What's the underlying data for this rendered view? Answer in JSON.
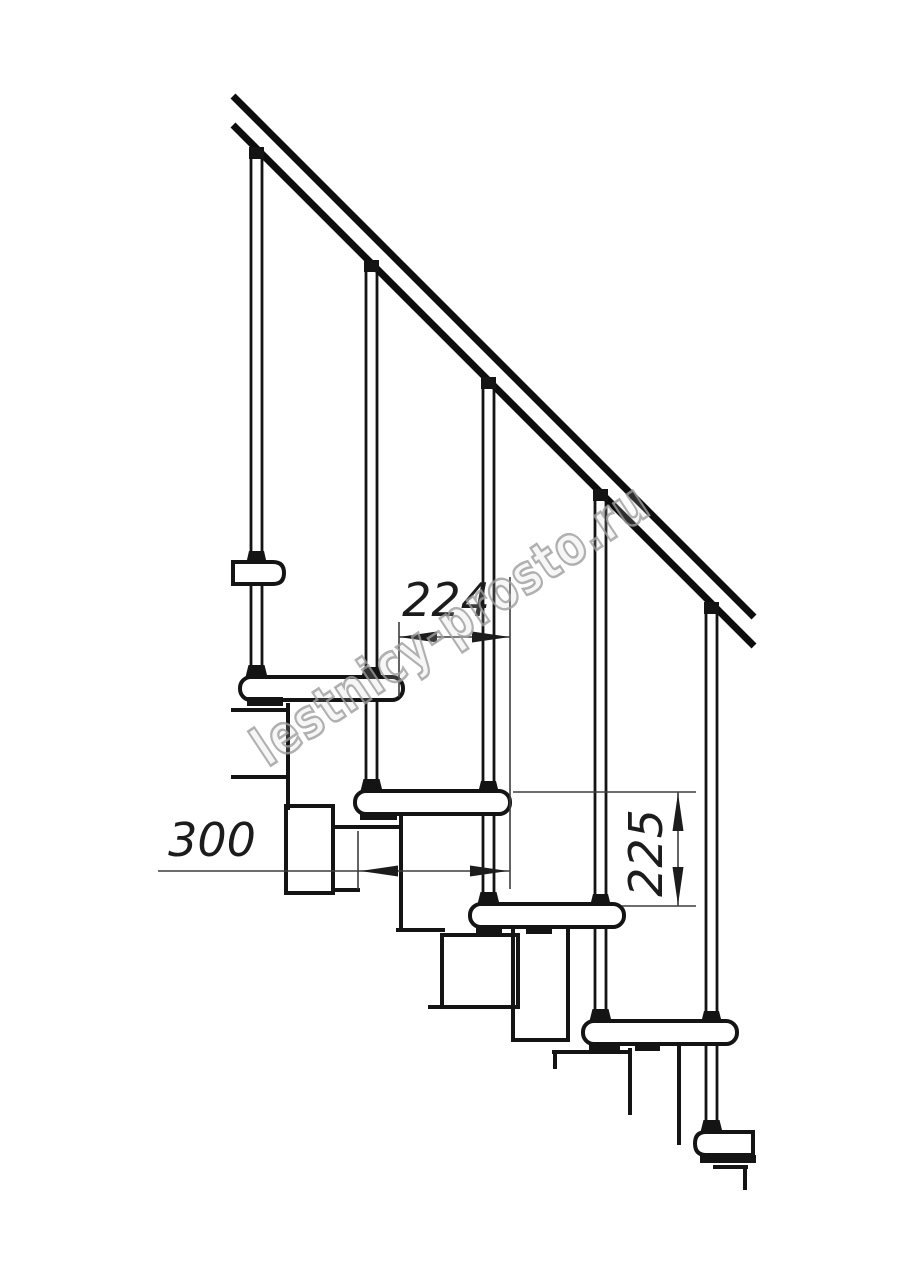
{
  "drawing": {
    "kind": "staircase-side-view-technical-drawing",
    "dimensions": {
      "run": {
        "label": "224"
      },
      "depth": {
        "label": "300"
      },
      "rise": {
        "label": "225"
      }
    },
    "watermark": {
      "text": "lestnicy-prosto.ru",
      "color": "#9e9e9e"
    },
    "colors": {
      "background": "#ffffff",
      "line": "#141414",
      "dimension_line": "#3d3d3d"
    }
  }
}
